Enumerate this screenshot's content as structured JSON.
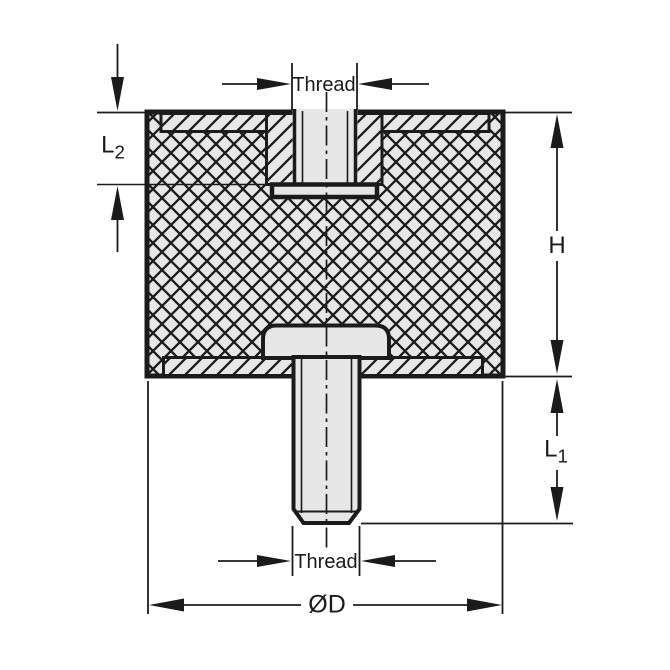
{
  "figure": {
    "type": "technical-drawing",
    "subject": "Cross-section of cylindrical rubber-metal vibration mount with female threaded insert on top and male threaded stud on bottom",
    "labels": {
      "thread_top": "Thread",
      "l2_base": "L",
      "l2_sub": "2",
      "h": "H",
      "l1_base": "L",
      "l1_sub": "1",
      "thread_bottom": "Thread",
      "diameter": "ØD"
    },
    "colors": {
      "line": "#1b1b1b",
      "part": "#e7e7e7",
      "background": "#ffffff"
    }
  }
}
